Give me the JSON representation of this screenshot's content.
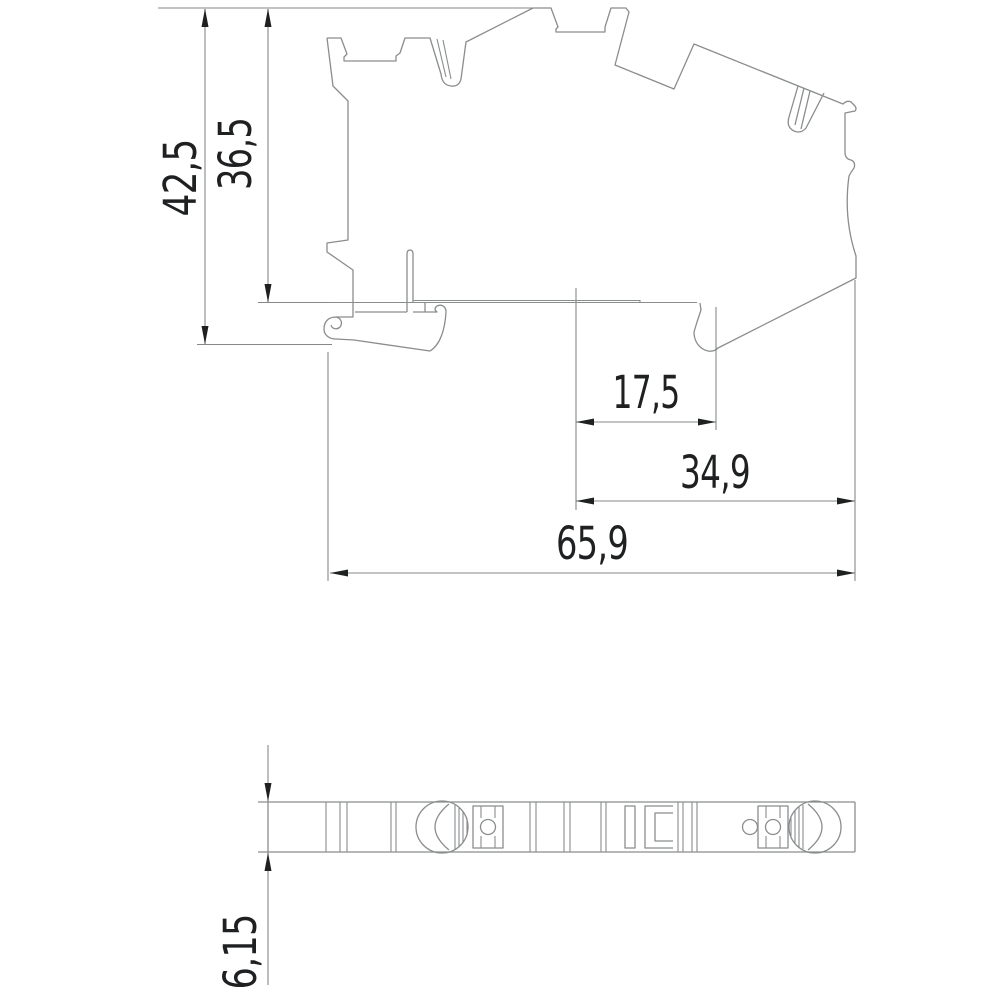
{
  "drawing": {
    "type": "technical-dimension-drawing",
    "views": [
      "side-view",
      "bottom-strip-view"
    ]
  },
  "colors": {
    "bg": "#ffffff",
    "line": "#8a8d8e",
    "dim": "#85888a",
    "ink": "#1f2021"
  },
  "dimensions": {
    "overall_height": "42,5",
    "upper_height": "36,5",
    "offset_small": "17,5",
    "offset_large": "34,9",
    "overall_length": "65,9",
    "thickness": "6,15"
  }
}
